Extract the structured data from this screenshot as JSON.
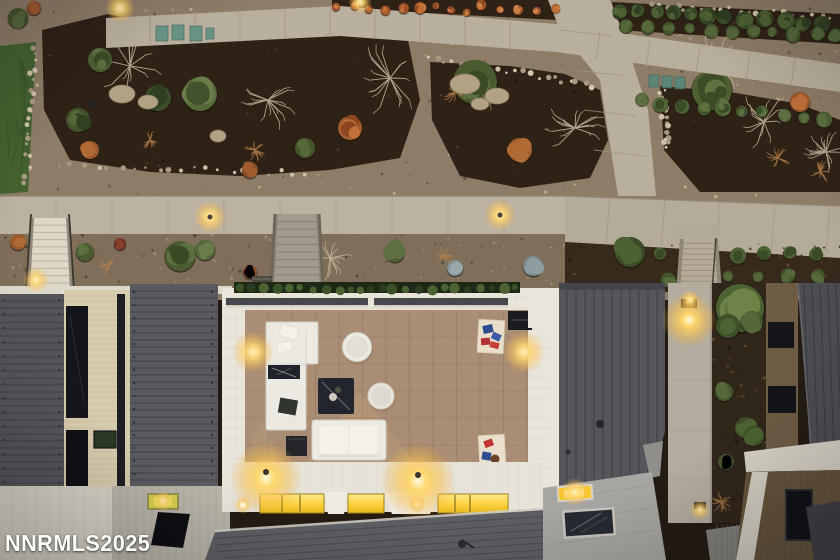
{
  "scene": {
    "type": "aerial-dusk-real-estate-photo",
    "description": "Straight-down drone photo at dusk: modern home rooftop deck with white outdoor furniture, fire-pit table, cornhole boards, amber accent lights and glowing clerestory windows; terraced desert landscaping above with concrete paths, staircases, mulch beds, shrubs and boulders; dark standing-seam metal roofs and a neighboring home at right",
    "watermark": {
      "text": "NNRMLS2025",
      "color": "#fdfdfa"
    },
    "labels": {
      "deck": "rooftop deck with tan tile",
      "furniture": [
        "white sectional sofa",
        "black marble coffee table",
        "fire pit table",
        "round side tables",
        "white loveseat",
        "cube side table",
        "cornhole boards with red and blue bags",
        "grill box"
      ],
      "landscape": [
        "concrete garden paths",
        "mulch beds",
        "gravel",
        "lawn patch",
        "boulders",
        "bare trees",
        "conifer shrubs",
        "rust shrubs",
        "hedge rows",
        "utility boxes"
      ],
      "structures": [
        "concrete walkway",
        "left stairs",
        "center stairs",
        "right stairs",
        "standing-seam roofs",
        "brick wall strip",
        "concrete pillar with sconce",
        "glowing clerestory windows",
        "skylights",
        "neighbor building"
      ]
    },
    "palette": {
      "gravel": "#8d7c66",
      "gravel_low": "#7f6f5a",
      "mulch": "#2e2116",
      "lawn": "#44622f",
      "concrete_path": "#b9af9e",
      "concrete_joint": "#a0957f",
      "stair_light": "#ddd7c8",
      "roof_dark": "#55565c",
      "roof_dark2": "#5a5b61",
      "roof_seam": "#3e3f44",
      "paver_white": "#e9e5db",
      "deck_tile": "#a98d74",
      "tile_grout": "#8f745a",
      "furniture_white": "#ebe9e2",
      "cushion_white": "#f3f1ea",
      "fire_pit": "#23252c",
      "beam_dark": "#46474d",
      "glow_amber": "#fdc95f",
      "window_yellow": "#f5c82e",
      "skylight_green": "#d6cf4e",
      "brick_wall": "#d8ccae",
      "brick_line": "#c4b698",
      "window_dark": "#15161b",
      "pillar": "#b4ad9f",
      "flat_roof": "#a8a6a2",
      "neighbor_brown": "#6f5d45",
      "neighbor_brown_low": "#66553d",
      "white_wall": "#d8d3c6",
      "shrub_green": "#4d6233",
      "shrub_green_dark": "#3a4c27",
      "shrub_rust": "#a05c2e",
      "shrub_gold": "#b5804a",
      "shrub_blue": "#7c8a8d",
      "bare_branch": "#cbbda2",
      "boulder": "#b3a183",
      "utility_teal": "#5f9183",
      "cornhole_blue": "#2f4c8e",
      "cornhole_red": "#c03434"
    }
  }
}
